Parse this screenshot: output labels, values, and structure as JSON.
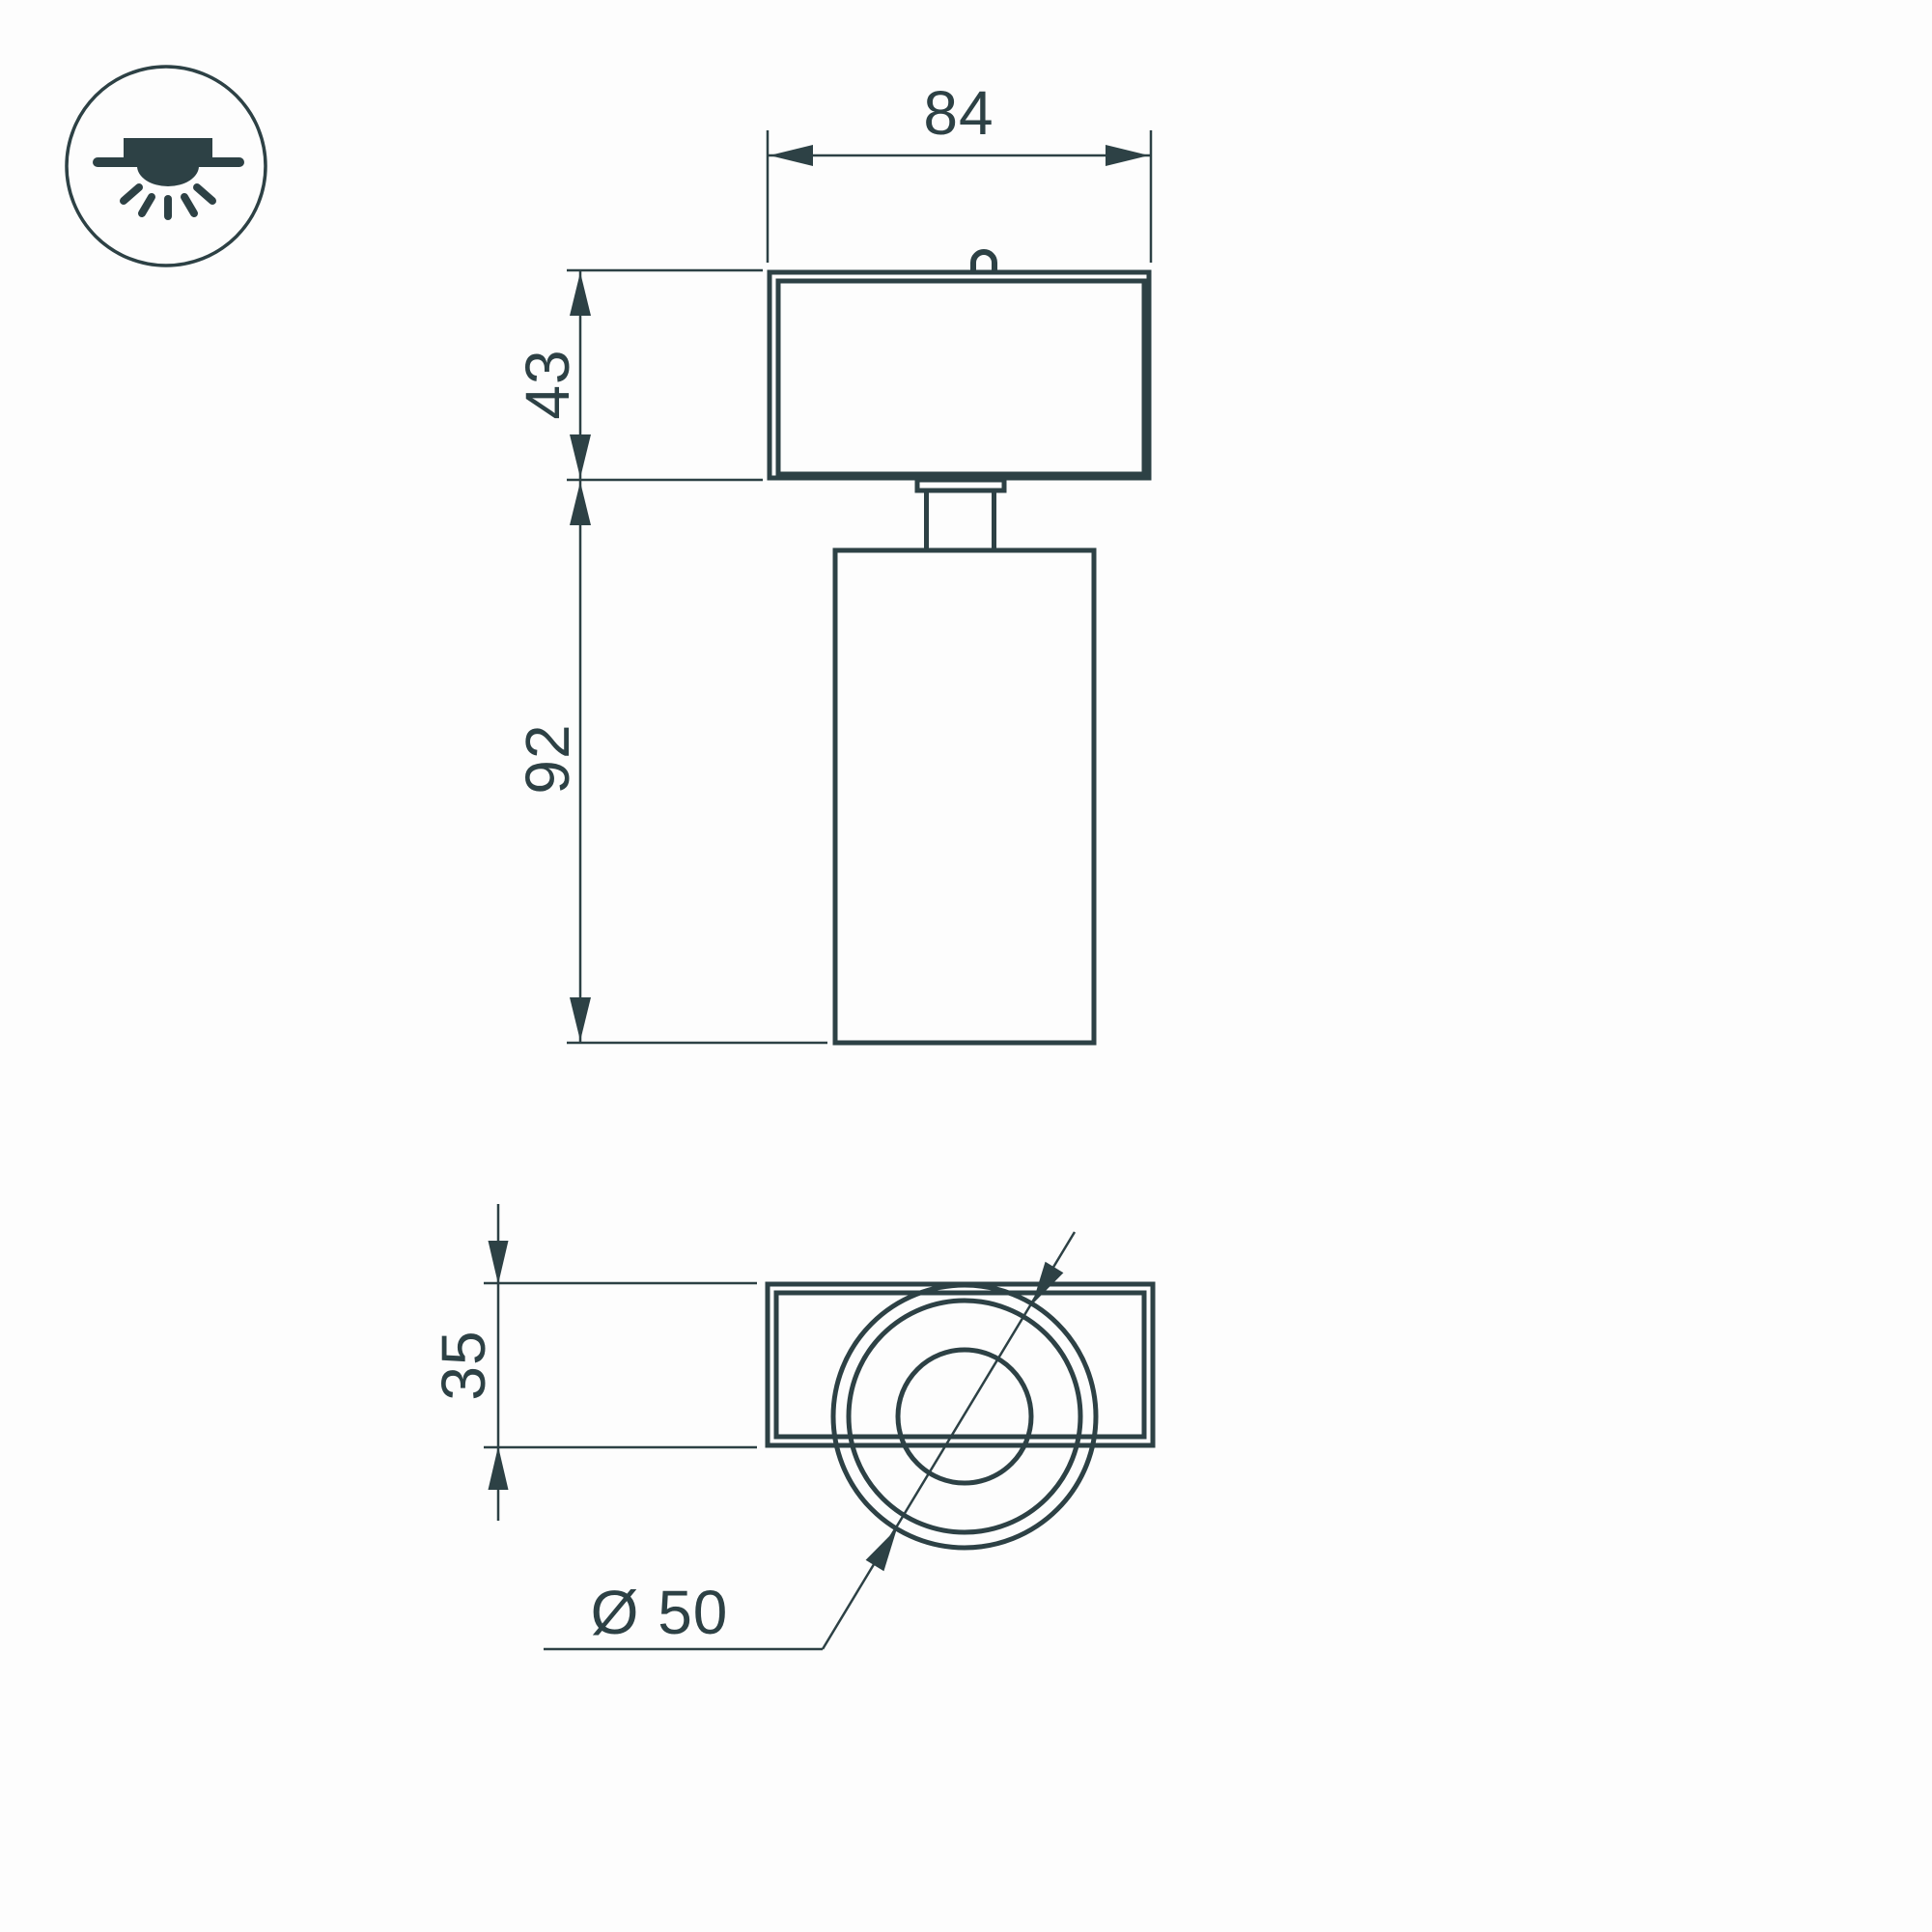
{
  "colors": {
    "ink": "#2d4145",
    "paper": "#fdfdfd"
  },
  "icons": {
    "mount": "ceiling-surface-downlight-icon"
  },
  "dimensions": {
    "head_width": {
      "label": "84"
    },
    "head_height": {
      "label": "43"
    },
    "body_height": {
      "label": "92"
    },
    "plate_height": {
      "label": "35"
    },
    "lens_diameter": {
      "label": "Ø 50"
    }
  }
}
